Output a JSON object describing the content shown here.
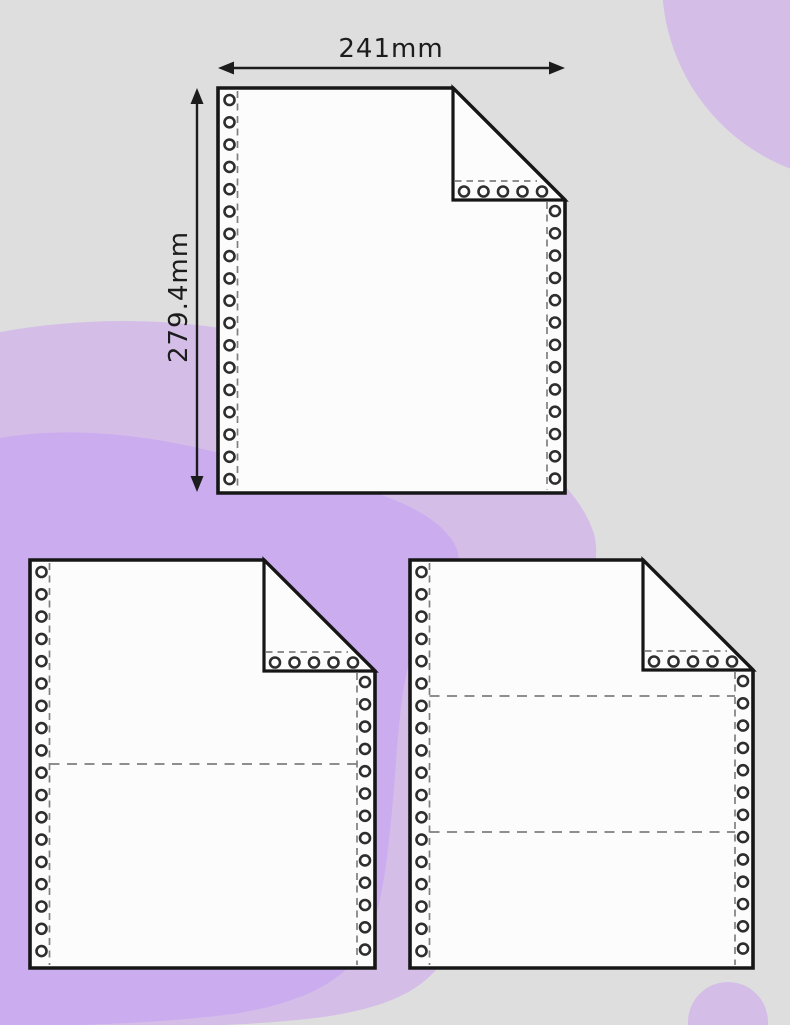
{
  "scene": {
    "background_color": "#dedede",
    "blob_color_light": "#d4bee8",
    "blob_color_bright": "#cbacef",
    "sheet_fill": "#fcfcfc",
    "outline_color": "#161616",
    "hole_ring_color": "#2e2e2e",
    "hole_fill_color": "#ffffff",
    "perforation_color": "#7f7f7f",
    "label_color": "#1c1c1c"
  },
  "dimensions": {
    "width_label": "241mm",
    "height_label": "279.4mm"
  },
  "sheets": [
    {
      "id": "sheet-single-ply",
      "parts": 1,
      "divider_lines": 0,
      "has_dimension_arrows": true
    },
    {
      "id": "sheet-two-ply",
      "parts": 2,
      "divider_lines": 1,
      "has_dimension_arrows": false
    },
    {
      "id": "sheet-three-ply",
      "parts": 3,
      "divider_lines": 2,
      "has_dimension_arrows": false
    }
  ]
}
